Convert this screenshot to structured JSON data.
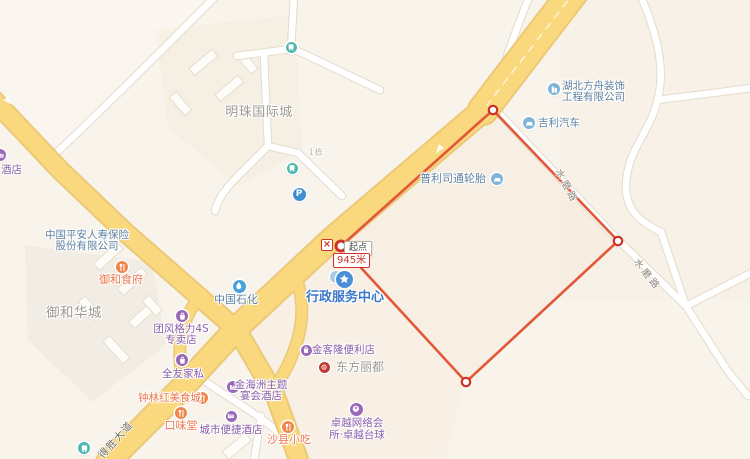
{
  "map": {
    "colors": {
      "route": "#e25839",
      "vertex": "#cd3228",
      "poi_purple": "#8a5fa8",
      "icon_purple": "#9a68b8",
      "poi_food": "#ed764e",
      "icon_food": "#f0854a",
      "poi_company": "#5e82a0",
      "icon_company": "#82b4d8",
      "poi_gov": "#3e79c9",
      "icon_gov": "#4a90d8",
      "area_gray": "#9c9a90",
      "muted_gray": "#bcb7a9",
      "road_label": "#8a8579",
      "road_label_dark": "#6f6a5c",
      "icon_bus": "#52b8ae",
      "icon_parking": "#3e8ed0",
      "icon_gas": "#4aa0d8",
      "icon_landmark": "#c23b35",
      "icon_light_dot": "#a6cae8",
      "major_road": "#f9d87e",
      "major_road_casing": "#ecc978"
    },
    "measure": {
      "start_label": "起点",
      "distance_label": "945米",
      "delete_symbol": "×"
    },
    "road_labels": [
      {
        "id": "shuimolu-upper",
        "text": "水磨路",
        "x": 565,
        "y": 166,
        "rotate": 62,
        "size": 9.5,
        "spacing": 3,
        "color_key": "road_label"
      },
      {
        "id": "shuimolu-lower",
        "text": "水磨路",
        "x": 642,
        "y": 255,
        "rotate": 52,
        "size": 9.5,
        "spacing": 3,
        "color_key": "road_label"
      },
      {
        "id": "deshengdadao",
        "text": "得胜大道",
        "x": 94,
        "y": 451,
        "rotate": -48,
        "size": 10,
        "spacing": 1.5,
        "color_key": "road_label_dark"
      }
    ],
    "area_labels": [
      {
        "id": "mingzhu-guojicheng",
        "text": "明珠国际城",
        "x": 259,
        "y": 101,
        "size": 13
      },
      {
        "id": "yuhe-huacheng",
        "text": "御和华城",
        "x": 74,
        "y": 301,
        "size": 13.5
      },
      {
        "id": "building-1-dong",
        "text": "1栋",
        "x": 316,
        "y": 146,
        "size": 8.5,
        "muted": true
      }
    ],
    "pois": [
      {
        "id": "hubei-fangzhou",
        "lines": [
          "湖北方舟装饰",
          "工程有限公司"
        ],
        "anchor": "left",
        "x": 562,
        "y": 81,
        "size": 10.5,
        "line_h": 11,
        "color_key": "poi_company",
        "icon": {
          "type": "company",
          "x": 554,
          "y": 89,
          "d": 12
        }
      },
      {
        "id": "jili-qiche",
        "lines": [
          "吉利汽车"
        ],
        "anchor": "left",
        "x": 538,
        "y": 117,
        "size": 10.5,
        "color_key": "poi_company",
        "icon": {
          "type": "car",
          "x": 529,
          "y": 123,
          "d": 12
        }
      },
      {
        "id": "pulisitong-luntai",
        "lines": [
          "普利司通轮胎"
        ],
        "anchor": "left",
        "x": 420,
        "y": 173,
        "size": 11,
        "color_key": "poi_company",
        "icon": {
          "type": "car",
          "x": 497,
          "y": 179,
          "d": 12
        }
      },
      {
        "id": "jiudian-partial",
        "lines": [
          "酒店"
        ],
        "anchor": "left",
        "x": 1,
        "y": 164,
        "size": 10.5,
        "color_key": "poi_purple",
        "icon": {
          "type": "hotel",
          "x": 0,
          "y": 155,
          "d": 12
        }
      },
      {
        "id": "zhongguo-pingan",
        "lines": [
          "中国平安人寿保险",
          "股份有限公司"
        ],
        "anchor": "center",
        "x": 87,
        "y": 230,
        "size": 10.5,
        "line_h": 11,
        "color_key": "poi_company",
        "icon": null
      },
      {
        "id": "yuhe-shifu",
        "lines": [
          "御和食府"
        ],
        "anchor": "center",
        "x": 121,
        "y": 274,
        "size": 11,
        "color_key": "poi_food",
        "icon": {
          "type": "food",
          "x": 122,
          "y": 267,
          "d": 12
        }
      },
      {
        "id": "zhongguo-shihua",
        "lines": [
          "中国石化"
        ],
        "anchor": "center",
        "x": 236,
        "y": 294,
        "size": 11,
        "color_key": "poi_company",
        "icon": {
          "type": "gas",
          "x": 239,
          "y": 286,
          "d": 13
        }
      },
      {
        "id": "xingzheng-badge",
        "lines": [],
        "anchor": "center",
        "x": 336,
        "y": 277,
        "size": 10,
        "color_key": "poi_gov",
        "icon": {
          "type": "light_dot",
          "x": 336,
          "y": 277,
          "d": 12
        }
      },
      {
        "id": "xingzheng-fuwu-zhongxin",
        "lines": [
          "行政服务中心"
        ],
        "anchor": "center",
        "x": 345,
        "y": 291,
        "size": 13,
        "bold": true,
        "color_key": "poi_gov",
        "icon": {
          "type": "gov",
          "x": 344,
          "y": 279,
          "d": 17
        }
      },
      {
        "id": "tuanfeng-geli-4s",
        "lines": [
          "团风格力4S",
          "专卖店"
        ],
        "anchor": "center",
        "x": 181,
        "y": 324,
        "size": 10.5,
        "line_h": 11,
        "color_key": "poi_purple",
        "icon": {
          "type": "shop",
          "x": 182,
          "y": 316,
          "d": 12
        }
      },
      {
        "id": "quanyou-jiasi",
        "lines": [
          "全友家私"
        ],
        "anchor": "center",
        "x": 183,
        "y": 368,
        "size": 10.5,
        "color_key": "poi_purple",
        "icon": {
          "type": "shop",
          "x": 182,
          "y": 360,
          "d": 12
        }
      },
      {
        "id": "jinkelong-bianlidian",
        "lines": [
          "金客隆便利店"
        ],
        "anchor": "left",
        "x": 312,
        "y": 344,
        "size": 10.5,
        "color_key": "poi_purple",
        "icon": {
          "type": "shop",
          "x": 306,
          "y": 350,
          "d": 11
        }
      },
      {
        "id": "dongfang-lidu",
        "lines": [
          "东方丽都"
        ],
        "anchor": "left",
        "x": 336,
        "y": 361,
        "size": 12,
        "color_key": "area_gray",
        "icon": {
          "type": "landmark",
          "x": 324,
          "y": 367,
          "d": 11
        }
      },
      {
        "id": "zhonglinhong-meishicheng",
        "lines": [
          "钟林红美食城"
        ],
        "anchor": "left",
        "x": 138,
        "y": 392,
        "size": 10.5,
        "color_key": "poi_food",
        "icon": {
          "type": "food",
          "x": 202,
          "y": 398,
          "d": 12
        }
      },
      {
        "id": "jinhaizhou-zhuti",
        "lines": [
          "金海洲主题",
          "宴会酒店"
        ],
        "anchor": "center",
        "x": 261,
        "y": 380,
        "size": 10.5,
        "line_h": 10.5,
        "color_key": "poi_purple",
        "icon": {
          "type": "hotel",
          "x": 233,
          "y": 387,
          "d": 12
        }
      },
      {
        "id": "kouweitang",
        "lines": [
          "口味堂"
        ],
        "anchor": "center",
        "x": 181,
        "y": 420,
        "size": 11,
        "color_key": "poi_food",
        "icon": {
          "type": "food",
          "x": 181,
          "y": 413,
          "d": 12
        }
      },
      {
        "id": "chengshi-bianjie-jiudian",
        "lines": [
          "城市便捷酒店"
        ],
        "anchor": "center",
        "x": 231,
        "y": 424,
        "size": 10.5,
        "color_key": "poi_purple",
        "icon": {
          "type": "hotel",
          "x": 231,
          "y": 416,
          "d": 11
        }
      },
      {
        "id": "shaxian-xiaochi",
        "lines": [
          "沙县小吃"
        ],
        "anchor": "center",
        "x": 289,
        "y": 434,
        "size": 11,
        "color_key": "poi_food",
        "icon": {
          "type": "food",
          "x": 288,
          "y": 427,
          "d": 12
        }
      },
      {
        "id": "zhuoyue-wangluo",
        "lines": [
          "卓越网络会",
          "所·卓越台球"
        ],
        "anchor": "center",
        "x": 357,
        "y": 418,
        "size": 10.5,
        "line_h": 11.5,
        "color_key": "poi_purple",
        "icon": {
          "type": "billiard",
          "x": 356,
          "y": 409,
          "d": 13
        }
      },
      {
        "id": "bus-stop-north",
        "lines": [],
        "anchor": "center",
        "x": 291,
        "y": 47,
        "size": 10,
        "color_key": "poi_company",
        "icon": {
          "type": "bus",
          "x": 291,
          "y": 47,
          "d": 11
        }
      },
      {
        "id": "bus-stop-mid",
        "lines": [],
        "anchor": "center",
        "x": 292,
        "y": 168,
        "size": 10,
        "color_key": "poi_company",
        "icon": {
          "type": "bus",
          "x": 292,
          "y": 168,
          "d": 11
        }
      },
      {
        "id": "parking-lot",
        "lines": [],
        "anchor": "center",
        "x": 299,
        "y": 194,
        "size": 10,
        "color_key": "poi_company",
        "icon": {
          "type": "parking",
          "x": 299,
          "y": 194,
          "d": 13
        }
      },
      {
        "id": "bus-stop-southwest",
        "lines": [],
        "anchor": "center",
        "x": 84,
        "y": 448,
        "size": 10,
        "color_key": "poi_company",
        "icon": {
          "type": "bus",
          "x": 84,
          "y": 448,
          "d": 12
        }
      }
    ]
  }
}
